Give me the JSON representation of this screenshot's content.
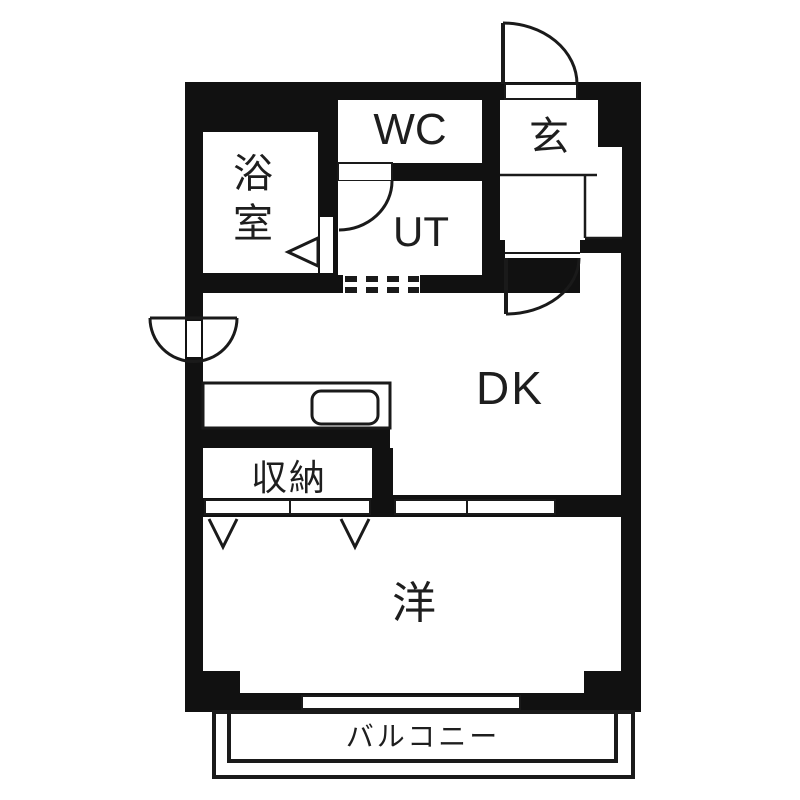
{
  "floorplan": {
    "type": "japanese-apartment-floor-plan",
    "colors": {
      "background": "#ffffff",
      "wall": "#111111",
      "line": "#1a1a1a",
      "text": "#1e1e1e"
    },
    "rooms": [
      {
        "id": "bathroom",
        "label": "浴室"
      },
      {
        "id": "toilet",
        "label": "WC"
      },
      {
        "id": "utility",
        "label": "UT"
      },
      {
        "id": "entrance",
        "label": "玄"
      },
      {
        "id": "dining-kitchen",
        "label": "DK"
      },
      {
        "id": "storage",
        "label": "収納"
      },
      {
        "id": "western-room",
        "label": "洋"
      },
      {
        "id": "balcony",
        "label": "バルコニー"
      }
    ]
  }
}
